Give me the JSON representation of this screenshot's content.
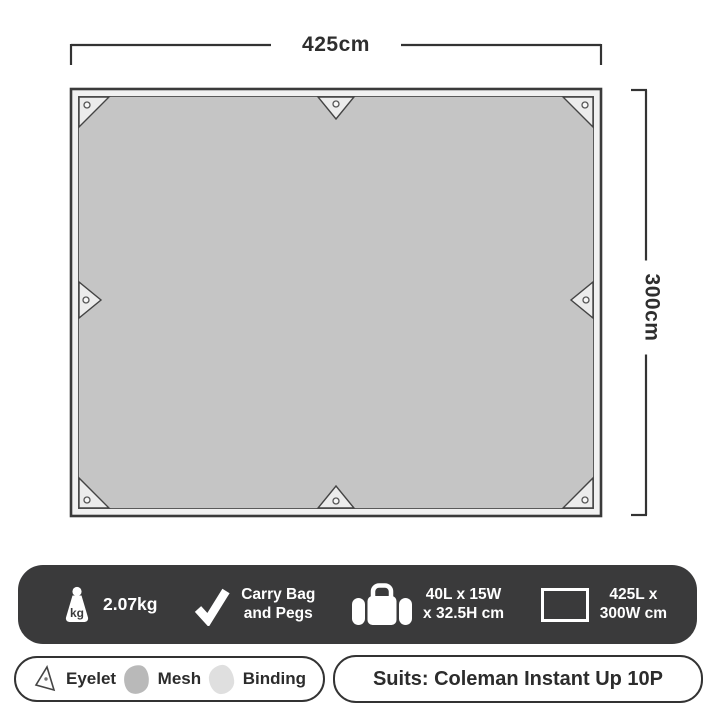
{
  "diagram": {
    "width_label": "425cm",
    "height_label": "300cm",
    "tarp_fill": "#c5c5c5",
    "binding_fill": "#f1f1f1",
    "patch_fill": "#ececec",
    "line_color": "#333333"
  },
  "spec_bar": {
    "background": "#3a3a3b",
    "text_color": "#ffffff",
    "weight": {
      "icon": "weight-kg-icon",
      "unit_label": "kg",
      "value": "2.07kg"
    },
    "included": {
      "icon": "checkmark-icon",
      "line1": "Carry Bag",
      "line2": "and Pegs"
    },
    "carry_bag_size": {
      "icon": "duffel-bag-icon",
      "line1": "40L x 15W",
      "line2": "x 32.5H cm"
    },
    "tarp_size": {
      "icon": "rectangle-outline-icon",
      "line1": "425L x",
      "line2": "300W cm"
    }
  },
  "legend": {
    "items": [
      {
        "icon": "eyelet-icon",
        "label": "Eyelet"
      },
      {
        "icon": "mesh-swatch",
        "label": "Mesh",
        "swatch_color": "#b9b9b9"
      },
      {
        "icon": "binding-swatch",
        "label": "Binding",
        "swatch_color": "#dfdfdf"
      }
    ]
  },
  "compatibility": {
    "label": "Suits: Coleman Instant Up 10P"
  }
}
